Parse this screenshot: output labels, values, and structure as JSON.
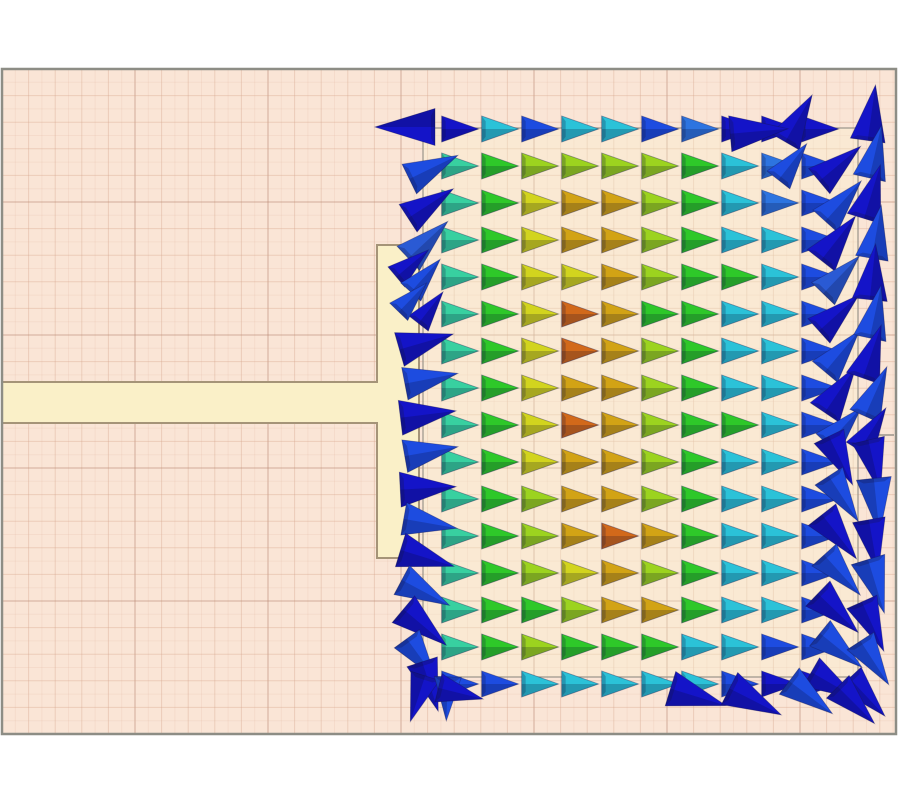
{
  "scene": {
    "canvas": {
      "w": 900,
      "h": 800,
      "bg": "#ffffff"
    },
    "plot": {
      "x": 2,
      "y": 69,
      "w": 894,
      "h": 665,
      "bg": "#fae5d6",
      "border_color": "#8d8d85",
      "border_width": 2.5
    },
    "grid": {
      "fine_step": 13.3,
      "fine_color": "rgba(224,178,158,0.20)",
      "minor_color": "rgba(214,162,140,0.38)",
      "major_color": "rgba(184,134,112,0.60)"
    },
    "t_feed": {
      "fill": "#faf0c8",
      "stroke": "#a59478",
      "stroke_width": 2,
      "points": [
        [
          2,
          382
        ],
        [
          377,
          382
        ],
        [
          377,
          245
        ],
        [
          419,
          245
        ],
        [
          419,
          558
        ],
        [
          377,
          558
        ],
        [
          377,
          423
        ],
        [
          2,
          423
        ]
      ]
    },
    "patch": {
      "x": 423,
      "y": 128,
      "w": 435,
      "h": 549,
      "fill": "rgba(250,240,206,0.35)",
      "stroke": "#9a948a",
      "stroke_width": 1.2
    },
    "port_line": {
      "x1": 858,
      "y1": 435,
      "x2": 894,
      "y2": 435,
      "color": "#9a948a",
      "width": 1.5
    }
  },
  "palette": {
    "db": "#1414c8",
    "bl": "#1d4ce0",
    "lb": "#2d74e0",
    "lb2": "#2a5ad4",
    "cy": "#2bc2d8",
    "tl": "#38d0a0",
    "tg": "#30cf72",
    "gr": "#2ec829",
    "g2": "#5ad222",
    "yg": "#9cd31f",
    "yl": "#d2d41e",
    "gd": "#d2a315",
    "or": "#d2691a",
    "ro": "#cd5a12"
  },
  "field": {
    "origin_x": 462,
    "origin_y": 129,
    "dx": 40,
    "dy": 37,
    "cone_len": 37,
    "cone_h": 26,
    "angle": 0,
    "rows": [
      [
        "db",
        "cy",
        "bl",
        "cy",
        "cy",
        "bl",
        "lb",
        "db",
        "db",
        "db"
      ],
      [
        "tl",
        "gr",
        "yg",
        "yg",
        "yg",
        "yg",
        "gr",
        "cy",
        "lb",
        "bl"
      ],
      [
        "tl",
        "gr",
        "yl",
        "gd",
        "gd",
        "yg",
        "gr",
        "cy",
        "lb",
        "bl"
      ],
      [
        "tl",
        "gr",
        "yl",
        "gd",
        "gd",
        "yg",
        "gr",
        "cy",
        "cy",
        "bl"
      ],
      [
        "tl",
        "gr",
        "yl",
        "yl",
        "gd",
        "yg",
        "gr",
        "gr",
        "cy",
        "bl"
      ],
      [
        "tl",
        "gr",
        "yl",
        "or",
        "gd",
        "gr",
        "gr",
        "cy",
        "cy",
        "bl"
      ],
      [
        "tl",
        "gr",
        "yl",
        "or",
        "gd",
        "yg",
        "gr",
        "cy",
        "cy",
        "bl"
      ],
      [
        "tl",
        "gr",
        "yl",
        "gd",
        "gd",
        "yg",
        "gr",
        "cy",
        "cy",
        "bl"
      ],
      [
        "tl",
        "gr",
        "yl",
        "or",
        "gd",
        "yg",
        "gr",
        "gr",
        "cy",
        "bl"
      ],
      [
        "tl",
        "gr",
        "yl",
        "gd",
        "gd",
        "yg",
        "gr",
        "cy",
        "cy",
        "bl"
      ],
      [
        "tl",
        "gr",
        "yg",
        "gd",
        "gd",
        "yg",
        "gr",
        "cy",
        "cy",
        "bl"
      ],
      [
        "tl",
        "gr",
        "yg",
        "gd",
        "or",
        "gd",
        "gr",
        "cy",
        "cy",
        "bl"
      ],
      [
        "tl",
        "gr",
        "yg",
        "yl",
        "gd",
        "yg",
        "gr",
        "cy",
        "cy",
        "bl"
      ],
      [
        "tl",
        "gr",
        "gr",
        "yg",
        "gd",
        "gd",
        "gr",
        "cy",
        "cy",
        "bl"
      ],
      [
        "tl",
        "gr",
        "yg",
        "gr",
        "gr",
        "gr",
        "cy",
        "cy",
        "bl",
        "bl"
      ],
      [
        "bl",
        "bl",
        "cy",
        "cy",
        "cy",
        "cy",
        "cy",
        "bl",
        "db",
        "db"
      ]
    ]
  },
  "edge_vectors": [
    [
      402,
      127,
      180,
      60,
      "db"
    ],
    [
      436,
      166,
      26,
      54,
      "bl"
    ],
    [
      433,
      202,
      33,
      54,
      "db"
    ],
    [
      430,
      238,
      43,
      54,
      "lb2"
    ],
    [
      414,
      262,
      40,
      42,
      "db"
    ],
    [
      427,
      274,
      48,
      44,
      "bl"
    ],
    [
      432,
      306,
      52,
      40,
      "db"
    ],
    [
      414,
      296,
      46,
      40,
      "bl"
    ],
    [
      429,
      341,
      16,
      56,
      "db"
    ],
    [
      434,
      378,
      11,
      54,
      "bl"
    ],
    [
      431,
      414,
      7,
      56,
      "db"
    ],
    [
      434,
      451,
      10,
      54,
      "bl"
    ],
    [
      431,
      488,
      3,
      56,
      "db"
    ],
    [
      433,
      524,
      -10,
      54,
      "bl"
    ],
    [
      430,
      559,
      -17,
      56,
      "db"
    ],
    [
      428,
      594,
      -28,
      54,
      "bl"
    ],
    [
      427,
      629,
      -40,
      56,
      "db"
    ],
    [
      423,
      661,
      -54,
      50,
      "bl"
    ],
    [
      431,
      689,
      -72,
      52,
      "db"
    ],
    [
      417,
      701,
      -108,
      48,
      "db"
    ],
    [
      447,
      701,
      -92,
      44,
      "bl"
    ],
    [
      463,
      694,
      -14,
      46,
      "db"
    ],
    [
      842,
      162,
      40,
      54,
      "db"
    ],
    [
      845,
      199,
      48,
      54,
      "bl"
    ],
    [
      840,
      236,
      52,
      56,
      "db"
    ],
    [
      843,
      273,
      46,
      52,
      "lb2"
    ],
    [
      841,
      311,
      42,
      54,
      "db"
    ],
    [
      844,
      349,
      50,
      54,
      "bl"
    ],
    [
      842,
      387,
      56,
      56,
      "db"
    ],
    [
      846,
      424,
      47,
      50,
      "bl"
    ],
    [
      842,
      463,
      -64,
      54,
      "db"
    ],
    [
      845,
      501,
      -57,
      54,
      "bl"
    ],
    [
      841,
      539,
      -52,
      56,
      "db"
    ],
    [
      844,
      577,
      -48,
      54,
      "bl"
    ],
    [
      840,
      615,
      -44,
      56,
      "db"
    ],
    [
      843,
      652,
      -39,
      54,
      "bl"
    ],
    [
      837,
      687,
      -30,
      54,
      "db"
    ],
    [
      872,
      110,
      82,
      56,
      "db"
    ],
    [
      876,
      149,
      77,
      54,
      "bl"
    ],
    [
      873,
      189,
      73,
      56,
      "db"
    ],
    [
      877,
      229,
      80,
      54,
      "bl"
    ],
    [
      873,
      269,
      84,
      56,
      "db"
    ],
    [
      876,
      309,
      78,
      54,
      "bl"
    ],
    [
      873,
      349,
      71,
      56,
      "db"
    ],
    [
      877,
      389,
      66,
      54,
      "bl"
    ],
    [
      874,
      427,
      58,
      50,
      "db"
    ],
    [
      875,
      469,
      -77,
      54,
      "db"
    ],
    [
      877,
      509,
      -84,
      56,
      "bl"
    ],
    [
      874,
      549,
      -80,
      54,
      "db"
    ],
    [
      877,
      589,
      -73,
      56,
      "bl"
    ],
    [
      874,
      629,
      -66,
      54,
      "db"
    ],
    [
      876,
      665,
      -57,
      52,
      "bl"
    ],
    [
      869,
      699,
      -47,
      52,
      "db"
    ],
    [
      800,
      116,
      60,
      54,
      "db"
    ],
    [
      794,
      160,
      52,
      46,
      "bl"
    ],
    [
      762,
      131,
      5,
      58,
      "db"
    ],
    [
      701,
      698,
      -17,
      58,
      "db"
    ],
    [
      758,
      703,
      -27,
      58,
      "db"
    ],
    [
      813,
      699,
      -37,
      54,
      "bl"
    ],
    [
      858,
      707,
      -45,
      52,
      "db"
    ]
  ]
}
